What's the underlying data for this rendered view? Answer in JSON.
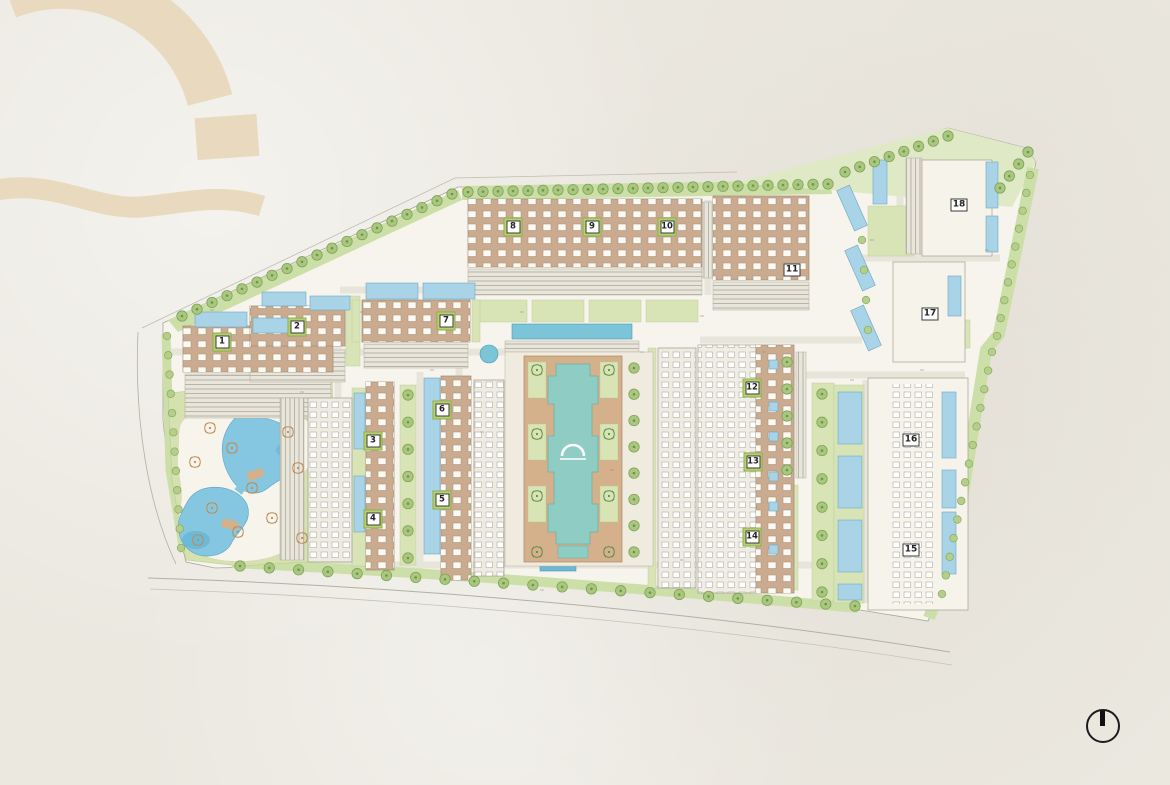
{
  "plan": {
    "type": "resort-master-site-plan",
    "buildings": [
      {
        "label": "1",
        "x": 222,
        "y": 342,
        "pad": true
      },
      {
        "label": "2",
        "x": 297,
        "y": 327,
        "pad": true
      },
      {
        "label": "3",
        "x": 373,
        "y": 441,
        "pad": true
      },
      {
        "label": "4",
        "x": 373,
        "y": 519,
        "pad": true
      },
      {
        "label": "5",
        "x": 442,
        "y": 500,
        "pad": true
      },
      {
        "label": "6",
        "x": 442,
        "y": 410,
        "pad": true
      },
      {
        "label": "7",
        "x": 446,
        "y": 321,
        "pad": true
      },
      {
        "label": "8",
        "x": 513,
        "y": 227,
        "pad": true
      },
      {
        "label": "9",
        "x": 592,
        "y": 227,
        "pad": true
      },
      {
        "label": "10",
        "x": 667,
        "y": 227,
        "pad": true
      },
      {
        "label": "11",
        "x": 792,
        "y": 270,
        "pad": false
      },
      {
        "label": "12",
        "x": 752,
        "y": 388,
        "pad": true
      },
      {
        "label": "13",
        "x": 753,
        "y": 462,
        "pad": true
      },
      {
        "label": "14",
        "x": 752,
        "y": 537,
        "pad": true
      },
      {
        "label": "15",
        "x": 911,
        "y": 550,
        "pad": false
      },
      {
        "label": "16",
        "x": 911,
        "y": 440,
        "pad": false
      },
      {
        "label": "17",
        "x": 930,
        "y": 314,
        "pad": false
      },
      {
        "label": "18",
        "x": 959,
        "y": 205,
        "pad": false
      }
    ],
    "colors": {
      "paper": "#ebe8e0",
      "plan_paper": "#f6f4ec",
      "lawn": "#d9e4b6",
      "tree_green": "#a9c77e",
      "pool_blue": "#a9d3e6",
      "lap_pool_blue": "#7cc4d8",
      "central_pool_teal": "#8fccc4",
      "lagoon_blue": "#85c6e0",
      "roof_tan": "#cbab8f",
      "deck_tan": "#d4b08b",
      "watermark_tan": "#e9dabf",
      "marker_green": "#b6d26e",
      "ink": "#1c1c1c"
    }
  },
  "icons": {
    "compass": "north-indicator-icon",
    "watermark": "dome-arch-logo",
    "pool_logo": "dome-arch-mark"
  }
}
